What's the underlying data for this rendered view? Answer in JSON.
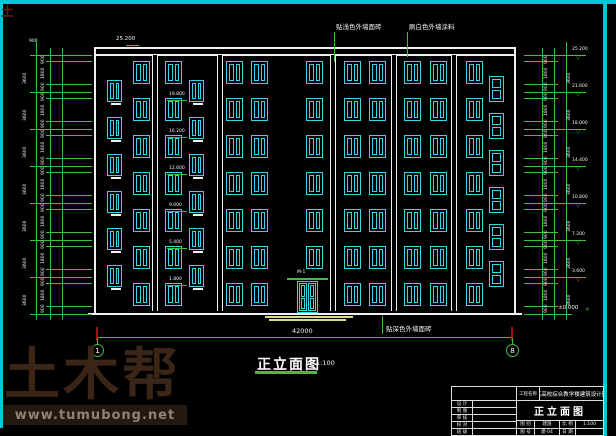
{
  "drawing": {
    "title": "正立面图",
    "scale": "1:100",
    "annotations": {
      "top_left": "贴浅色外墙面砖",
      "top_right": "刷白色外墙涂料",
      "bottom": "贴深色外墙面砖",
      "door_label": "M-1",
      "roof_level": "25.200",
      "ground_level": "±0.000"
    },
    "axis_bubbles": [
      "1",
      "8"
    ],
    "total_width_dim": "42000",
    "parapet_dim": "900",
    "floor_height_dims": [
      "3600",
      "3600",
      "3600",
      "3600",
      "3600",
      "3600",
      "3600"
    ],
    "sub_dims": [
      "900",
      "1800",
      "900"
    ],
    "levels": [
      "25.200",
      "21.600",
      "18.000",
      "14.400",
      "10.800",
      "7.200",
      "3.600"
    ],
    "stair_levels": [
      "19.800",
      "16.200",
      "12.600",
      "9.000",
      "5.400",
      "1.800"
    ],
    "building": {
      "outline": {
        "x": 94,
        "y": 47,
        "w": 422,
        "h": 266
      },
      "floor_lines_y": [
        55,
        92,
        129,
        166,
        203,
        240,
        277,
        314
      ],
      "pilaster_x": [
        152,
        217,
        330,
        391,
        451
      ],
      "normal_windows": {
        "cols": [
          133,
          165,
          226,
          251,
          306,
          344,
          369,
          404,
          430,
          466
        ],
        "rows": [
          61,
          98,
          135,
          172,
          209,
          246,
          283
        ],
        "w": 17,
        "h": 23,
        "skip": [
          [
            4,
            6
          ]
        ]
      },
      "stair_windows": {
        "cols": [
          107,
          189
        ],
        "rows": [
          80,
          117,
          154,
          191,
          228,
          265
        ],
        "w": 15,
        "h": 22
      },
      "landing_windows": {
        "cols": [
          489
        ],
        "rows": [
          76,
          113,
          150,
          187,
          224,
          261
        ],
        "w": 15,
        "h": 26
      },
      "door": {
        "x": 297,
        "y": 281,
        "w": 21,
        "h": 32
      }
    },
    "colors": {
      "frame": "#00c6d8",
      "lines": "#f0f0f0",
      "windows": "#3cd4e4",
      "dimensions": "#3fbf3f",
      "ground": "#d9d98f",
      "axis_tick": "#a01010"
    }
  },
  "titleblock": {
    "project_label": "工程名称",
    "project_name": "某高校综合教学楼建筑设计图",
    "drawing_title": "正立面图",
    "left_labels": [
      "设 计",
      "制 图",
      "审 核",
      "校 对",
      "班 级"
    ],
    "row_a": [
      "图 别",
      "建施",
      "比 例",
      "1:100"
    ],
    "row_b": [
      "图 号",
      "建-04",
      "日 期",
      ""
    ]
  },
  "watermark": {
    "brand": "土木帮",
    "url": "www.tumubong.net",
    "corner": "土"
  }
}
